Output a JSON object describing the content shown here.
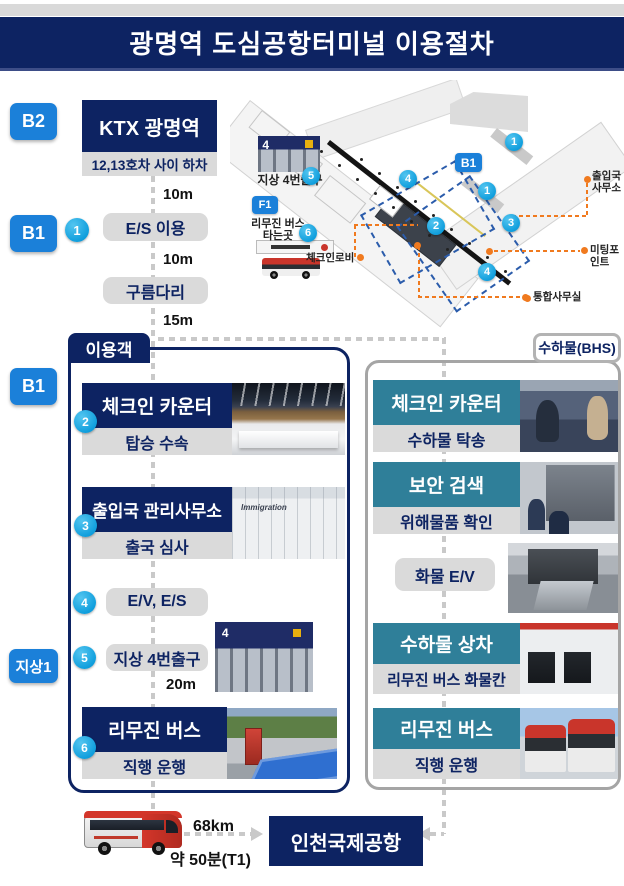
{
  "title": "광명역 도심공항터미널 이용절차",
  "floors": {
    "b2": "B2",
    "b1_upper": "B1",
    "b1_lower": "B1",
    "ground": "지상1"
  },
  "flow": {
    "start": "KTX 광명역",
    "start_sub": "12,13호차 사이 하차",
    "dist1": "10m",
    "step1_num": "1",
    "step1": "E/S 이용",
    "dist2": "10m",
    "bridge": "구름다리",
    "dist3": "15m"
  },
  "passenger": {
    "header": "이용객",
    "steps": [
      {
        "num": "2",
        "title": "체크인 카운터",
        "sub": "탑승 수속"
      },
      {
        "num": "3",
        "title": "출입국 관리사무소",
        "sub": "출국 심사"
      },
      {
        "num": "4",
        "title": "E/V, E/S"
      },
      {
        "num": "5",
        "title": "지상 4번출구",
        "dist": "20m"
      },
      {
        "num": "6",
        "title": "리무진 버스",
        "sub": "직행 운행"
      }
    ]
  },
  "baggage": {
    "header": "수하물(BHS)",
    "steps": [
      {
        "title": "체크인 카운터",
        "sub": "수하물 탁송"
      },
      {
        "title": "보안 검색",
        "sub": "위해물품 확인"
      },
      {
        "title": "화물 E/V"
      },
      {
        "title": "수하물 상차",
        "sub": "리무진 버스 화물칸"
      },
      {
        "title": "리무진 버스",
        "sub": "직행 운행"
      }
    ]
  },
  "map": {
    "b1": "B1",
    "f1": "F1",
    "exit4": "지상 4번출구",
    "limo_line1": "리무진 버스",
    "limo_line2": "타는곳",
    "checkin_lobby": "체크인로비",
    "immigration_line1": "출입국",
    "immigration_line2": "사무소",
    "meeting_point": "미팅포인트",
    "office": "통합사무실",
    "markers": [
      "1",
      "1",
      "2",
      "3",
      "4",
      "4",
      "5",
      "6"
    ]
  },
  "photos": {
    "immigration_sign": "Immigration",
    "exit_sign_number": "4"
  },
  "bottom": {
    "distance": "68km",
    "duration": "약 50분(T1)",
    "destination": "인천국제공항"
  },
  "colors": {
    "navy": "#0d2362",
    "badge_blue": "#1b80d9",
    "marker_cyan": "#17a7e5",
    "bhs_teal": "#2f7f99",
    "orange": "#f07a1f",
    "map_dashed_blue": "#2b5cab"
  }
}
